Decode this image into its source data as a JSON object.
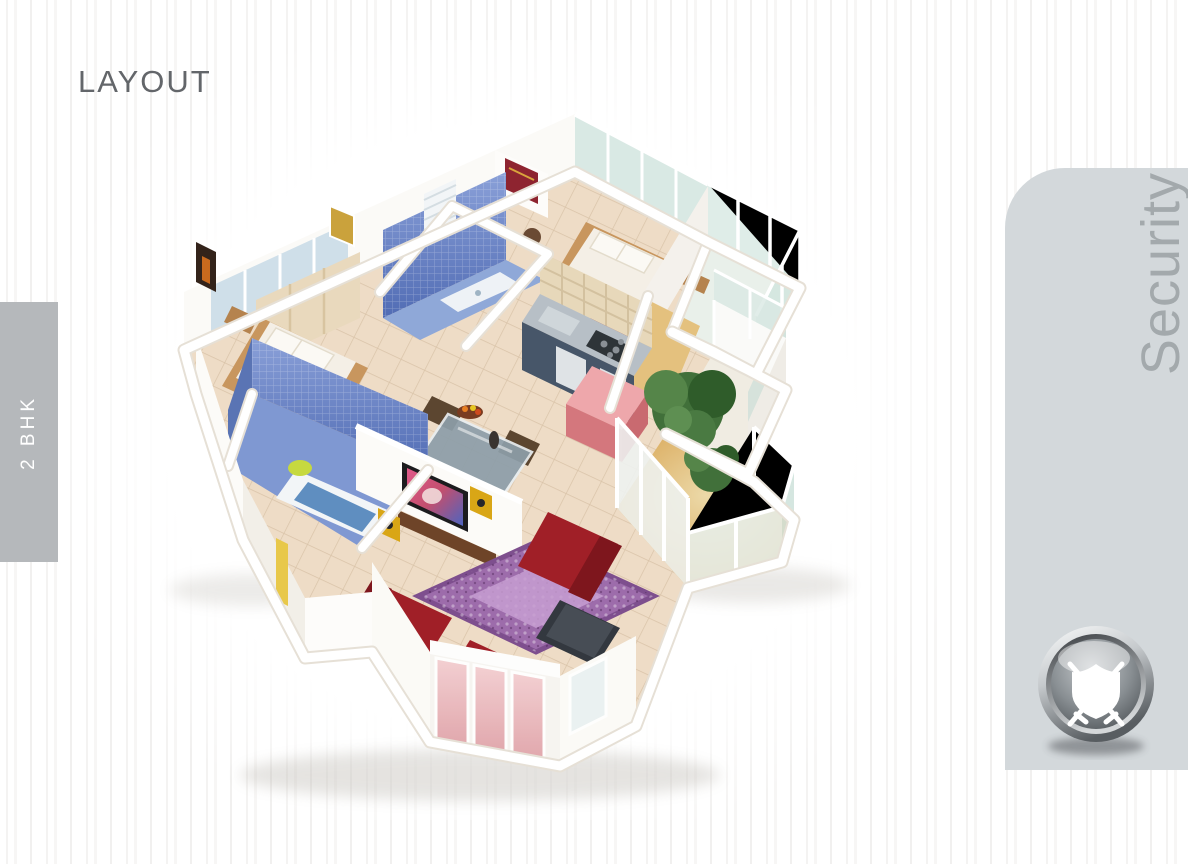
{
  "page": {
    "title": "LAYOUT"
  },
  "left_tab": {
    "label": "2 BHK"
  },
  "right_panel": {
    "label": "Security",
    "icon": "shield-with-swords-icon"
  },
  "floor_plan": {
    "icon": "isometric-floor-plan-render"
  },
  "colors": {
    "panel_gray": "#d3d8db",
    "tab_gray": "#b5b8bb",
    "title_gray": "#63666a",
    "security_text_gray": "#a3a9ac",
    "floor_beige": "#eedcc6",
    "bath_blue": "#6d87c6",
    "sofa_red": "#a01f27",
    "rug_purple": "#9d6cab",
    "balcony_gold": "#d3a049"
  }
}
